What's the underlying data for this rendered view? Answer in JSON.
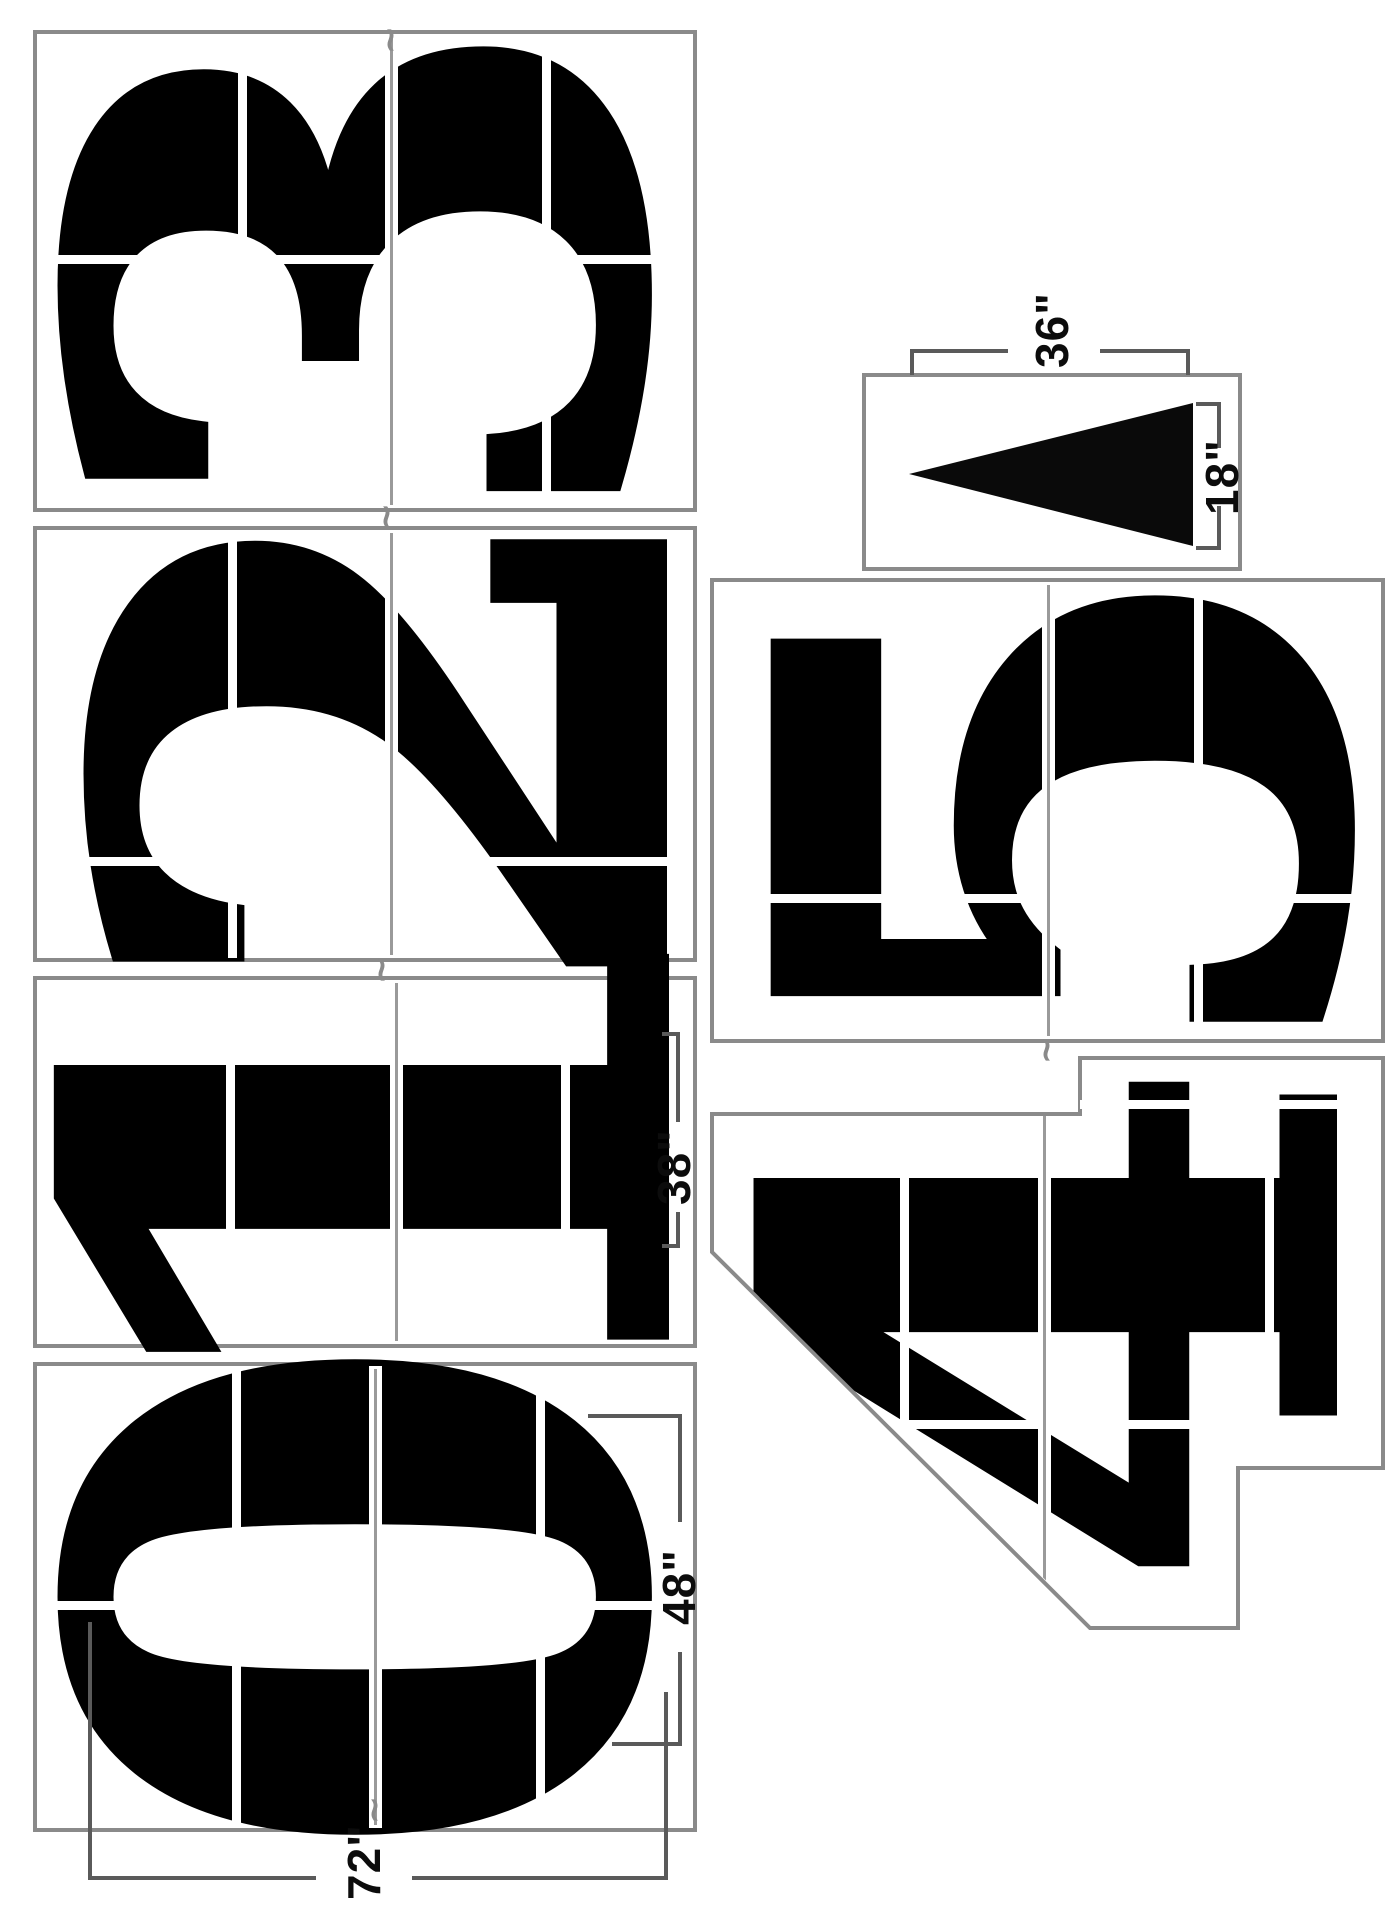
{
  "panels": {
    "p3": {
      "digit": "3"
    },
    "p2": {
      "digit": "2"
    },
    "p1": {
      "digit": "1"
    },
    "p0": {
      "digit": "0"
    },
    "p5": {
      "digit": "5"
    },
    "p4": {
      "digit": "4"
    },
    "arrow": {
      "symbol": "arrow-left-triangle"
    }
  },
  "dimensions": {
    "arrow_length": "36\"",
    "arrow_base": "18\"",
    "numeral_1_width": "38\"",
    "numeral_0_width": "48\"",
    "numeral_height": "72\""
  },
  "registration_mark": "~"
}
